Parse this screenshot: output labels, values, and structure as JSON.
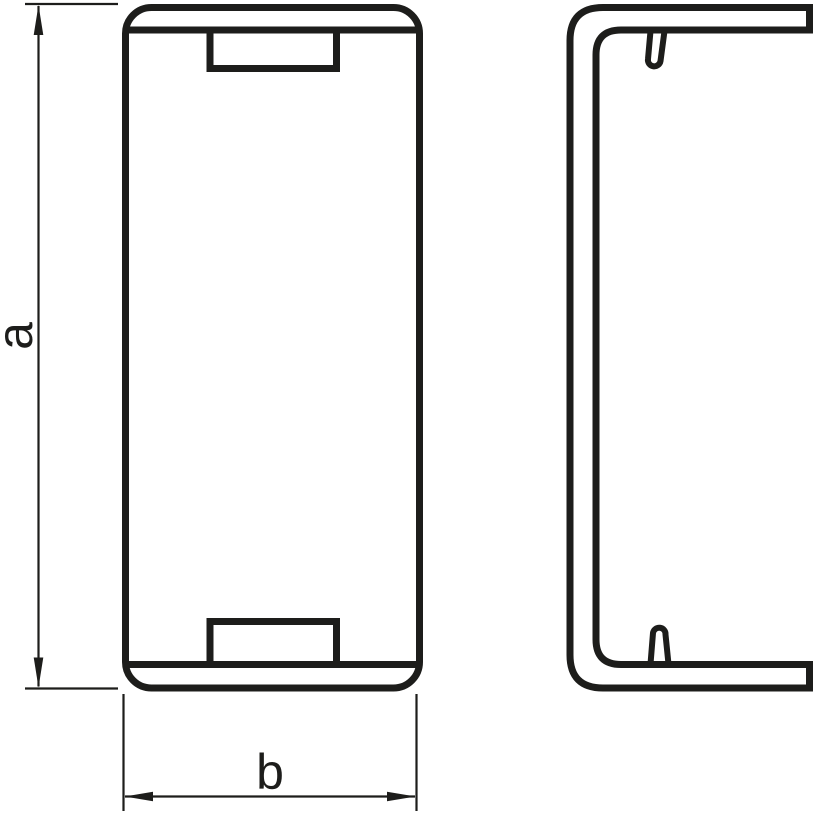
{
  "drawing": {
    "line_color": "#1d1d1b",
    "background_color": "#ffffff",
    "dimensions": {
      "height_label": "a",
      "width_label": "b"
    }
  }
}
